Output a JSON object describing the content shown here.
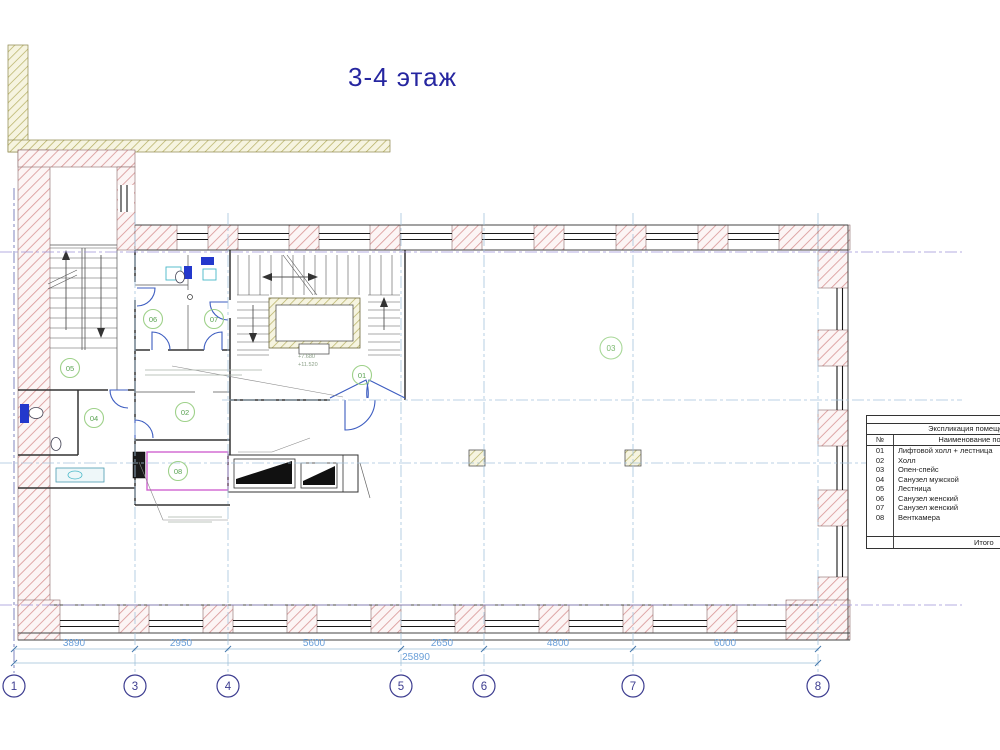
{
  "title": "3-4 этаж",
  "legend": {
    "title": "Экспликация помещений",
    "col_no": "№",
    "col_name": "Наименование помещения",
    "footer": "Итого",
    "rows": [
      {
        "no": "01",
        "name": "Лифтовой холл + лестница"
      },
      {
        "no": "02",
        "name": "Холл"
      },
      {
        "no": "03",
        "name": "Опен-спейс"
      },
      {
        "no": "04",
        "name": "Санузел мужской"
      },
      {
        "no": "05",
        "name": "Лестница"
      },
      {
        "no": "06",
        "name": "Санузел женский"
      },
      {
        "no": "07",
        "name": "Санузел женский"
      },
      {
        "no": "08",
        "name": "Венткамера"
      }
    ]
  },
  "axes": [
    "1",
    "3",
    "4",
    "5",
    "6",
    "7",
    "8"
  ],
  "dimensions": {
    "segments": [
      "3890",
      "2950",
      "5600",
      "2650",
      "4800",
      "6000"
    ],
    "total": "25890"
  },
  "room_labels": [
    "01",
    "02",
    "03",
    "04",
    "05",
    "06",
    "07",
    "08"
  ],
  "levels": {
    "upper": "+7.680",
    "lower": "+11.520"
  },
  "colors": {
    "title_blue": "#2626a0",
    "dimension_blue": "#6a9fd8",
    "axis_navy": "#3d3d90",
    "room_circle_green": "#9ed189",
    "wall_hatch_pink": "#da9a9a",
    "existing_hatch_olive": "#b3ad5e",
    "grid_blue": "#a5c4dc",
    "door_blue": "#3c5cc0",
    "fixture_blue": "#2338cc",
    "vent_outline_magenta": "#cf63cf"
  }
}
